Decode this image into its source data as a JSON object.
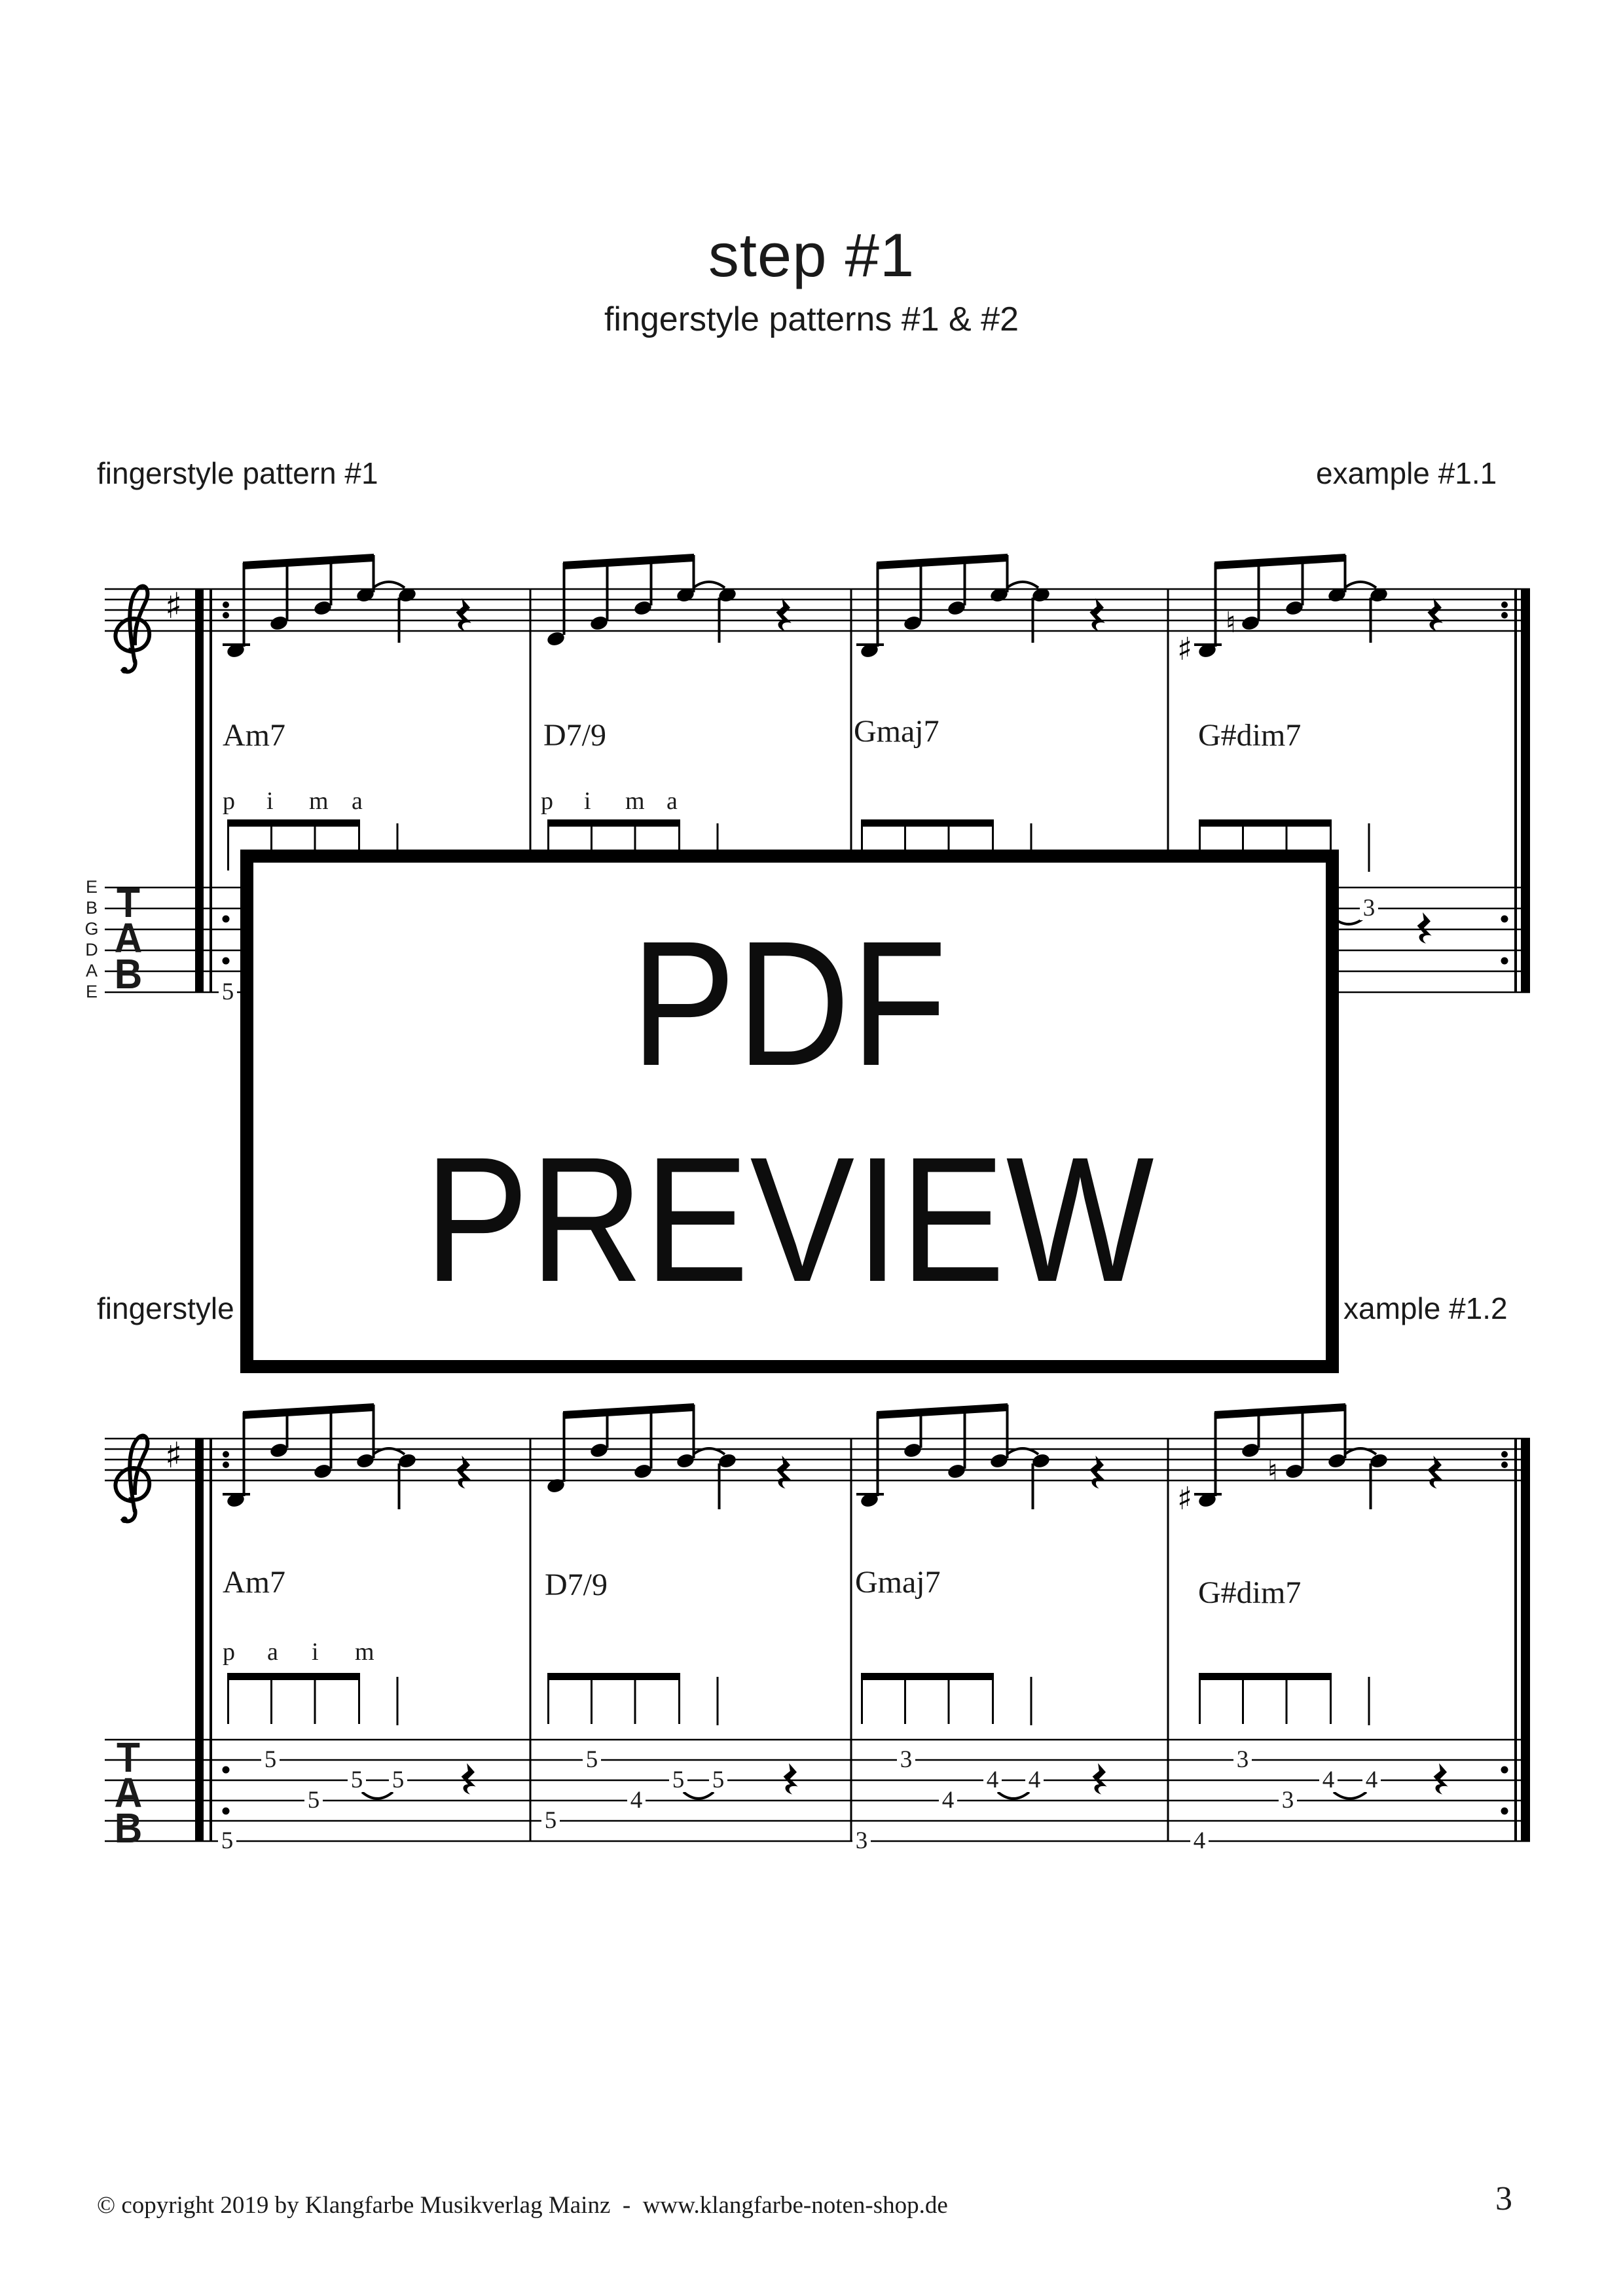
{
  "header": {
    "title": "step #1",
    "subtitle": "fingerstyle patterns #1 & #2"
  },
  "section1": {
    "left_label": "fingerstyle pattern #1",
    "right_label": "example #1.1"
  },
  "section2": {
    "left_label": "fingerstyle",
    "right_label": "xample #1.2"
  },
  "overlay": {
    "line1": "PDF",
    "line2": "PREVIEW"
  },
  "footer": {
    "copyright": "© copyright 2019 by Klangfarbe Musikverlag Mainz  -  www.klangfarbe-noten-shop.de",
    "page_number": "3"
  },
  "glyphs": {
    "sharp": "♯",
    "natural": "♮"
  },
  "notation": {
    "clef": "treble",
    "key_signature": "1 sharp",
    "string_labels": [
      "E",
      "B",
      "G",
      "D",
      "A",
      "E"
    ],
    "tab_label": [
      "T",
      "A",
      "B"
    ],
    "system1": {
      "chords": [
        "Am7",
        "D7/9",
        "Gmaj7",
        "G#dim7"
      ],
      "fingering_m1": [
        "p",
        "i",
        "m",
        "a"
      ],
      "fingering_m2": [
        "p",
        "i",
        "m",
        "a"
      ],
      "visible_tab": {
        "m1_bass": "5",
        "m4_tie": "3"
      }
    },
    "system2": {
      "chords": [
        "Am7",
        "D7/9",
        "Gmaj7",
        "G#dim7"
      ],
      "fingering_m1": [
        "p",
        "a",
        "i",
        "m"
      ],
      "tab_m1": [
        "5",
        "5",
        "5",
        "5",
        "5"
      ],
      "tab_m2": [
        "5",
        "5",
        "4",
        "5",
        "5"
      ],
      "tab_m3": [
        "3",
        "3",
        "4",
        "4",
        "4"
      ],
      "tab_m4": [
        "4",
        "3",
        "3",
        "4",
        "4"
      ]
    }
  }
}
